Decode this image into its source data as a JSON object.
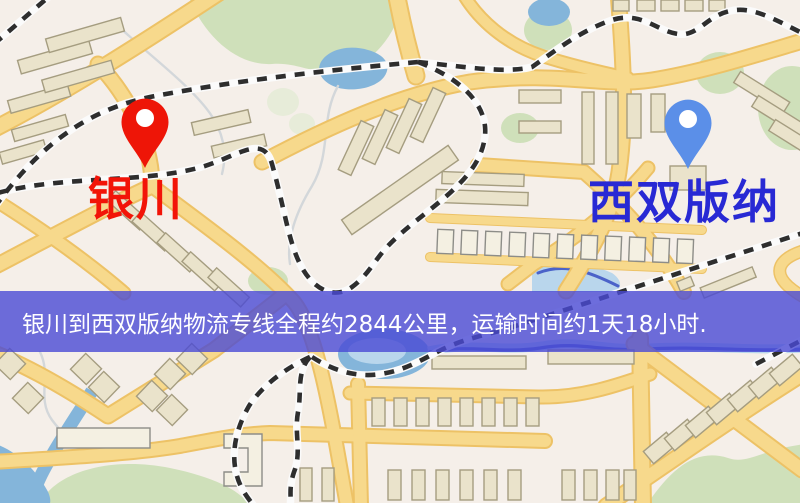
{
  "map": {
    "markers": [
      {
        "id": "origin",
        "label": "银川",
        "pin": "red-pin"
      },
      {
        "id": "destination",
        "label": "西双版纳",
        "pin": "blue-pin"
      }
    ]
  },
  "banner": {
    "text": "银川到西双版纳物流专线全程约2844公里，运输时间约1天18小时."
  },
  "colors": {
    "map-bg": "#f5efe9",
    "park": "#cfe0ba",
    "park-pale": "#e7ecd9",
    "water": "#84b5da",
    "water-light": "#b9d6ec",
    "river-line": "#4b63c9",
    "stream": "#d3d7da",
    "road-fill": "#f7d98c",
    "road-edge": "#edc266",
    "building-fill": "#eae3cb",
    "building-edge": "#a59d80",
    "rail-dash": "#2e2e2e",
    "origin-pin": "#ee1507",
    "destination-pin": "#5b8fe8",
    "origin-label": "#f21408",
    "destination-label": "#2829d4",
    "banner-bg": "rgba(74,74,213,0.8)",
    "banner-text": "#ffffff"
  }
}
